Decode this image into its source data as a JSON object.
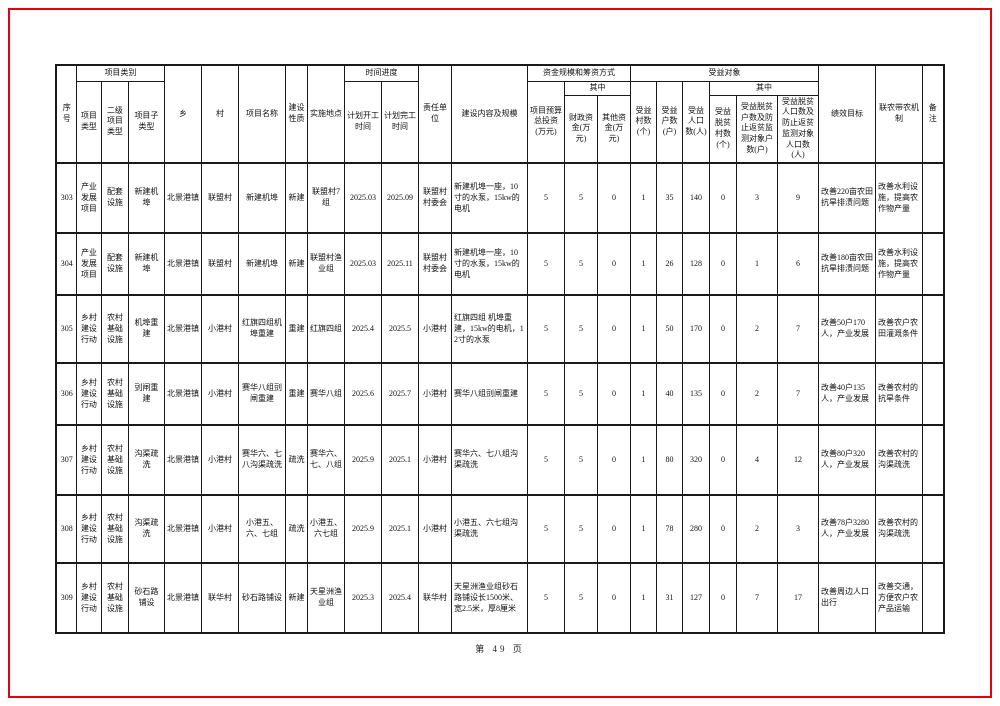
{
  "page": {
    "footer": "第 49 页",
    "frame_color": "#e60012"
  },
  "table": {
    "header": {
      "xuhao": "序号",
      "xiangmu_leibie": "项目类别",
      "xiangmu_leixing": "项目类型",
      "erji_leixing": "二级项目类型",
      "zi_leixing": "项目子类型",
      "xiang": "乡",
      "cun": "村",
      "mingcheng": "项目名称",
      "xingzhi": "建设性质",
      "didian": "实施地点",
      "shijian_jindu": "时间进度",
      "kaigong": "计划开工时间",
      "wangong": "计划完工时间",
      "zeren_danwei": "责任单位",
      "neirong_guimo": "建设内容及规模",
      "zijin_guimo": "资金规模和筹资方式",
      "yusuan": "项目预算总投资(万元)",
      "qizhong_zijin": "其中",
      "caizheng": "财政资金(万元)",
      "qita": "其他资金(万元)",
      "shouyi_duixiang": "受益对象",
      "shouyi_cunshu": "受益村数(个)",
      "shouyi_hushu": "受益户数(户)",
      "shouyi_renkou": "受益人口数(人)",
      "qizhong_shouyi": "其中",
      "tuopin_cunshu": "受益脱贫村数(个)",
      "tuopin_hushu": "受益脱贫户数及防止返贫监测对象户数(户)",
      "tuopin_renkou": "受益脱贫人口数及防止返贫监测对象人口数(人)",
      "jixiao": "绩效目标",
      "liannong": "联农带农机制",
      "beizhu": "备注"
    },
    "rows": [
      [
        "303",
        "产业发展项目",
        "配套设施",
        "新建机埠",
        "北景港镇",
        "联盟村",
        "新建机埠",
        "新建",
        "联盟村7组",
        "2025.03",
        "2025.09",
        "联盟村村委会",
        "新建机埠一座，10寸的水泵，15kw的电机",
        "5",
        "5",
        "0",
        "1",
        "35",
        "140",
        "0",
        "3",
        "9",
        "改善220亩农田抗旱排渍问题",
        "改善水利设施，提高农作物产量",
        ""
      ],
      [
        "304",
        "产业发展项目",
        "配套设施",
        "新建机埠",
        "北景港镇",
        "联盟村",
        "新建机埠",
        "新建",
        "联盟村渔业组",
        "2025.03",
        "2025.11",
        "联盟村村委会",
        "新建机埠一座，10寸的水泵，15kw的电机",
        "5",
        "5",
        "0",
        "1",
        "26",
        "128",
        "0",
        "1",
        "6",
        "改善180亩农田抗旱排渍问题",
        "改善水利设施，提高农作物产量",
        ""
      ],
      [
        "305",
        "乡村建设行动",
        "农村基础设施",
        "机埠重建",
        "北景港镇",
        "小港村",
        "红旗四组机埠重建",
        "重建",
        "红旗四组",
        "2025.4",
        "2025.5",
        "小港村",
        "红旗四组 机埠重建，15kw的电机，12寸的水泵",
        "5",
        "5",
        "0",
        "1",
        "50",
        "170",
        "0",
        "2",
        "7",
        "改善50户170人，产业发展",
        "改善农户农田灌溉条件",
        ""
      ],
      [
        "306",
        "乡村建设行动",
        "农村基础设施",
        "剅闸重建",
        "北景港镇",
        "小港村",
        "赛华八组剅闸重建",
        "重建",
        "赛华八组",
        "2025.6",
        "2025.7",
        "小港村",
        "赛华八组剅闸重建",
        "5",
        "5",
        "0",
        "1",
        "40",
        "135",
        "0",
        "2",
        "7",
        "改善40户135人，产业发展",
        "改善农村的抗旱条件",
        ""
      ],
      [
        "307",
        "乡村建设行动",
        "农村基础设施",
        "沟渠疏洗",
        "北景港镇",
        "小港村",
        "赛华六、七八沟渠疏洗",
        "疏洗",
        "赛华六、七、八组",
        "2025.9",
        "2025.1",
        "小港村",
        "赛华六、七八组沟渠疏洗",
        "5",
        "5",
        "0",
        "1",
        "80",
        "320",
        "0",
        "4",
        "12",
        "改善80户320人，产业发展",
        "改善农村的沟渠疏洗",
        ""
      ],
      [
        "308",
        "乡村建设行动",
        "农村基础设施",
        "沟渠疏洗",
        "北景港镇",
        "小港村",
        "小港五、六、七组",
        "疏洗",
        "小港五、六七组",
        "2025.9",
        "2025.1",
        "小港村",
        "小港五、六七组沟渠疏洗",
        "5",
        "5",
        "0",
        "1",
        "78",
        "280",
        "0",
        "2",
        "3",
        "改善78户3280人，产业发展",
        "改善农村的沟渠疏洗",
        ""
      ],
      [
        "309",
        "乡村建设行动",
        "农村基础设施",
        "砂石路铺设",
        "北景港镇",
        "联华村",
        "砂石路铺设",
        "新建",
        "天星洲渔业组",
        "2025.3",
        "2025.4",
        "联华村",
        "天星洲渔业组砂石路铺设长1500米、宽2.5米，厚8厘米",
        "5",
        "5",
        "0",
        "1",
        "31",
        "127",
        "0",
        "7",
        "17",
        "改善周边人口出行",
        "改善交通，方便农户农产品运输",
        ""
      ]
    ]
  }
}
